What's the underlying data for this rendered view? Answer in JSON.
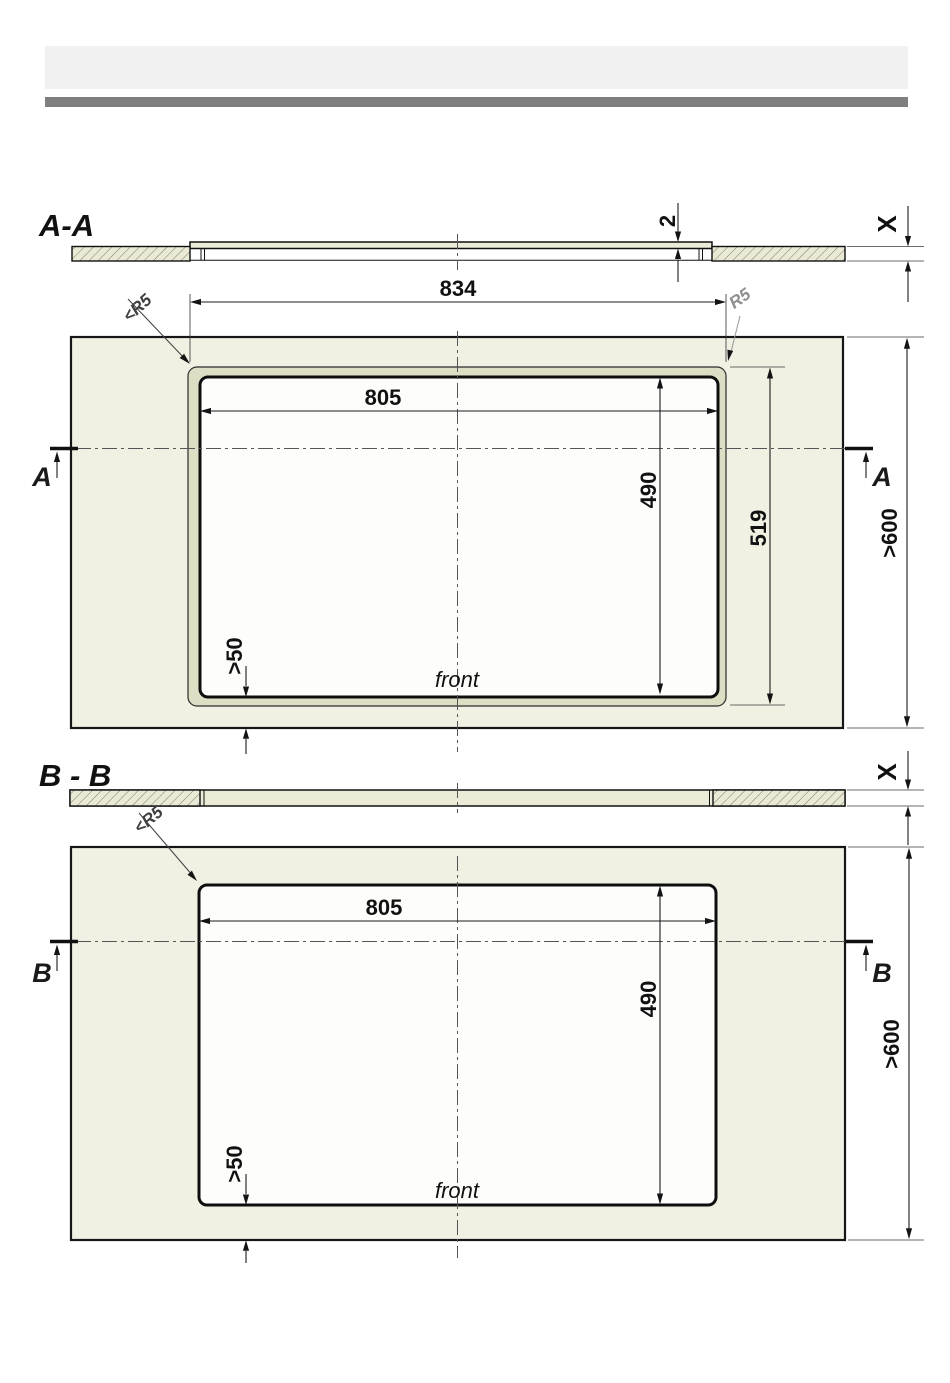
{
  "drawing": {
    "type": "installation-cutout-technical-drawing",
    "sections": {
      "section_a": {
        "label": "A-A",
        "marker": "A"
      },
      "section_b": {
        "label": "B - B",
        "marker": "B"
      }
    },
    "annotations": {
      "front": "front",
      "thickness_unknown": "X",
      "glass_step_mm": "2",
      "corner_radius_max": "<R5",
      "corner_radius": "R5"
    },
    "dimensions_mm": {
      "glass_width": "834",
      "cutout_width": "805",
      "cutout_depth": "490",
      "glass_depth": "519",
      "worktop_min_depth": ">600",
      "min_rear_clearance": ">50"
    },
    "colors": {
      "worktop_fill": "#f1f1e3",
      "lip_fill": "#dedec4",
      "plate_fill": "#ebebd8",
      "cutout_fill": "#fdfdfb",
      "header_bar_light": "#f1f1f1",
      "header_bar_dark": "#7f7f7f"
    }
  }
}
